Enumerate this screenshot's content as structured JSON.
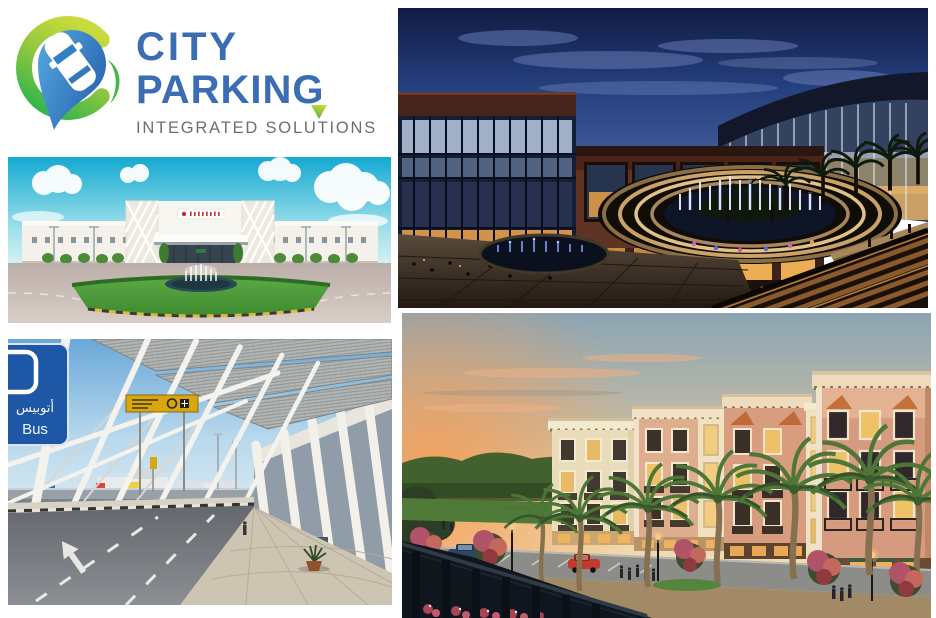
{
  "logo": {
    "line1": "CITY",
    "line2": "PARKING",
    "tagline": "INTEGRATED SOLUTIONS",
    "colors": {
      "blue": "#3a6db4",
      "gray": "#6d6e71",
      "green_light": "#a6ce39",
      "green_dark": "#3db54a",
      "pin_blue_light": "#4fa3d9",
      "pin_blue_dark": "#2a66b2"
    }
  },
  "photos": {
    "mall_night": {
      "palette": {
        "sky": "#1c2b5e",
        "brick_facade": "#5f3425",
        "interior_glow": "#e8a84f",
        "fountain_water": "#0d1526",
        "amphitheater_stone": "#caa268"
      }
    },
    "hospital": {
      "palette": {
        "sky": "#18b0d6",
        "building": "#f4f2ec",
        "lawn": "#4f9e3c",
        "road": "#c2b4ae",
        "sign_red": "#c03232"
      }
    },
    "airport": {
      "bus_sign": {
        "arabic": "أتوبيس",
        "english": "Bus",
        "bg": "#1d57a5"
      },
      "palette": {
        "sky": "#6aa8d8",
        "structure_white": "#f2f1ea",
        "road": "#64686e",
        "sidewalk": "#cdc4b1",
        "direction_sign_yellow": "#d8a60e"
      }
    },
    "residential": {
      "palette": {
        "sky_warm": "#f2a261",
        "sky_cool": "#8ba4b2",
        "facade_pink": "#d69a7e",
        "facade_cream": "#e9dcb8",
        "awning_orange": "#c4703a",
        "palm_green": "#4e7637",
        "railing_dark": "#10161e"
      }
    }
  }
}
